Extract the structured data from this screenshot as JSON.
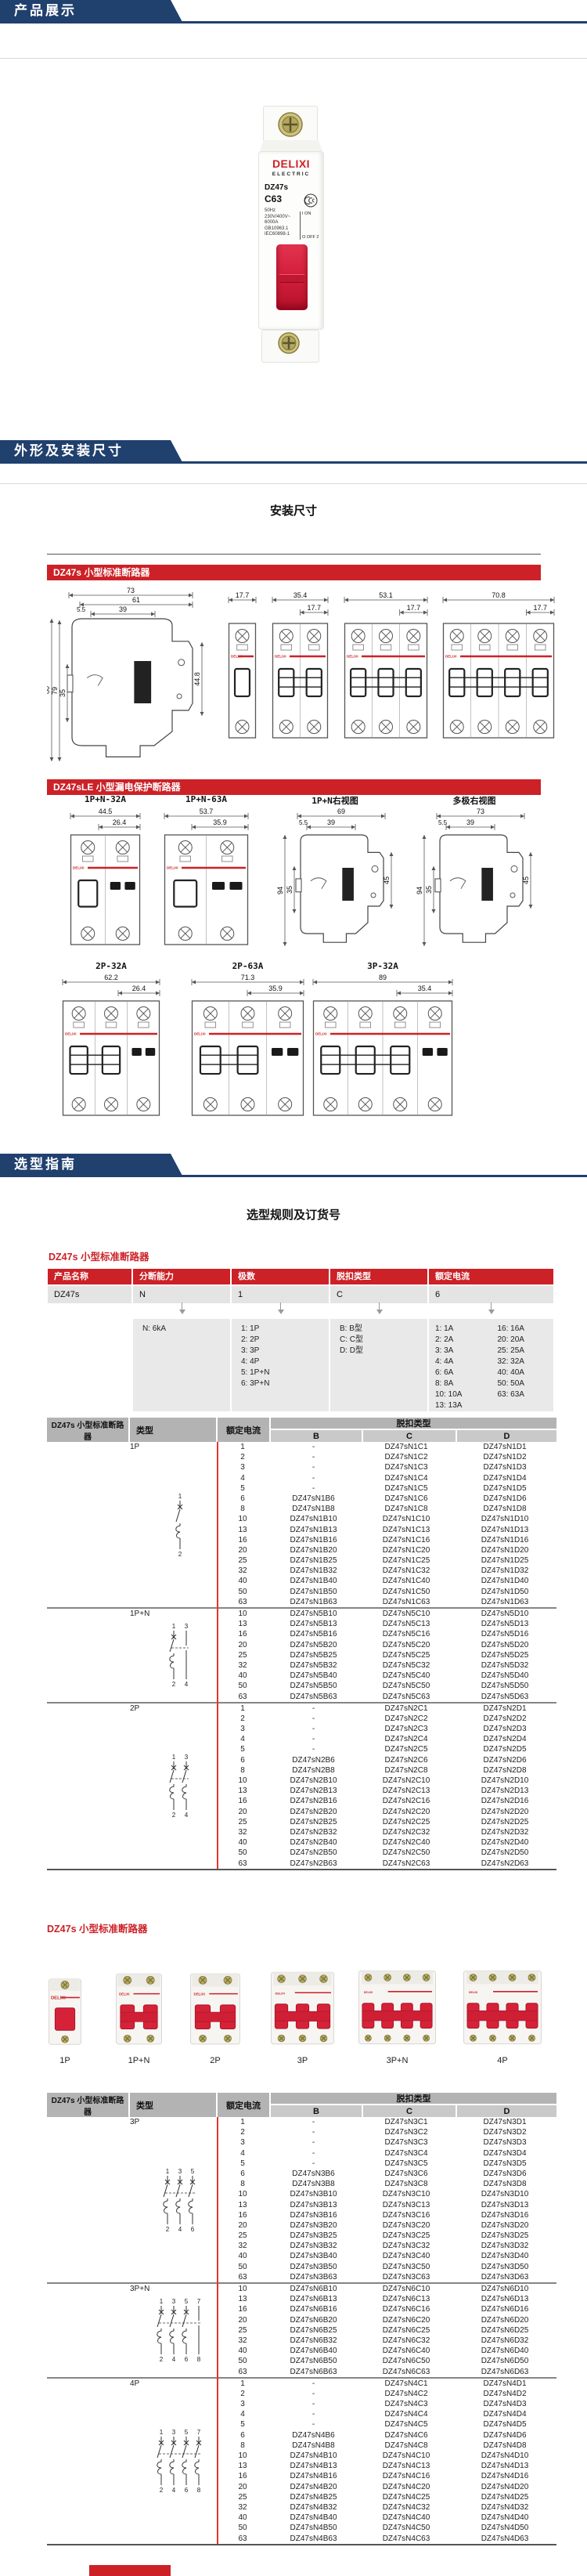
{
  "banners": {
    "products": "产品展示",
    "dimensions": "外形及安装尺寸",
    "selection": "选型指南"
  },
  "photo": {
    "brand": "DELIXI",
    "brand_sub": "ELECTRIC",
    "model": "DZ47s",
    "curve_rating": "C63",
    "specs": [
      "50Hz",
      "230V/400V~",
      "6000A",
      "GB10963.1",
      "IEC60898-1"
    ],
    "on_label": "I ON",
    "off_label": "O OFF 2",
    "ccc_mark": "CCC"
  },
  "install": {
    "title": "安装尺寸",
    "dz47s_banner": "DZ47s 小型标准断路器",
    "dz47sle_banner": "DZ47sLE 小型漏电保护断路器",
    "side_dims": {
      "total_w": "73",
      "body_w": "61",
      "mount_w": "39",
      "offset": "5.5",
      "total_h": "80",
      "front_h": "79",
      "rail_h": "35",
      "depth": "44.8"
    },
    "front_views": [
      {
        "total": "17.7"
      },
      {
        "total": "35.4",
        "module": "17.7"
      },
      {
        "total": "53.1",
        "module": "17.7"
      },
      {
        "total": "70.8",
        "module": "17.7"
      }
    ],
    "le_row1": [
      {
        "label": "1P+N-32A",
        "total": "44.5",
        "inner": "26.4"
      },
      {
        "label": "1P+N-63A",
        "total": "53.7",
        "inner": "35.9"
      },
      {
        "label": "1P+N右视图",
        "top": "69",
        "offset": "5.5",
        "mount": "39",
        "height": "94",
        "rail": "35",
        "depth": "45"
      },
      {
        "label": "多极右视图",
        "top": "73",
        "offset": "5.5",
        "mount": "39",
        "height": "94",
        "rail": "35",
        "depth": "45"
      }
    ],
    "le_row2": [
      {
        "label": "2P-32A",
        "total": "62.2",
        "inner": "26.4"
      },
      {
        "label": "2P-63A",
        "total": "71.3",
        "inner": "35.9"
      },
      {
        "label": "3P-32A",
        "total": "89",
        "inner": "35.4"
      }
    ]
  },
  "selection": {
    "title": "选型规则及订货号",
    "rule_table_title": "DZ47s 小型标准断路器",
    "rule_headers": [
      "产品名称",
      "分断能力",
      "极数",
      "脱扣类型",
      "额定电流"
    ],
    "rule_values": [
      "DZ47s",
      "N",
      "1",
      "C",
      "6"
    ],
    "breaking": [
      "N: 6kA"
    ],
    "poles": [
      "1: 1P",
      "2: 2P",
      "3: 3P",
      "4: 4P",
      "5: 1P+N",
      "6: 3P+N"
    ],
    "trip": [
      "B: B型",
      "C: C型",
      "D: D型"
    ],
    "current_a": [
      "1: 1A",
      "2: 2A",
      "3: 3A",
      "4: 4A",
      "6: 6A",
      "8: 8A",
      "10: 10A",
      "13: 13A"
    ],
    "current_b": [
      "16: 16A",
      "20: 20A",
      "25: 25A",
      "32: 32A",
      "40: 40A",
      "50: 50A",
      "63: 63A"
    ]
  },
  "gallery": {
    "title": "DZ47s 小型标准断路器",
    "items": [
      {
        "label": "1P",
        "modules": 1
      },
      {
        "label": "1P+N",
        "modules": 2
      },
      {
        "label": "2P",
        "modules": 2
      },
      {
        "label": "3P",
        "modules": 3
      },
      {
        "label": "3P+N",
        "modules": 4
      },
      {
        "label": "4P",
        "modules": 4
      }
    ]
  },
  "table1": {
    "col1": "DZ47s 小型标准断路器",
    "type_h": "类型",
    "current_h": "额定电流",
    "trip_h": "脱扣类型",
    "trip_cols": [
      "B",
      "C",
      "D"
    ],
    "sections": [
      {
        "type": "1P",
        "sym": {
          "poles": 1,
          "neutral": false,
          "top": "1",
          "bottom": "2"
        },
        "rows": [
          [
            "1",
            "-",
            "DZ47sN1C1",
            "DZ47sN1D1"
          ],
          [
            "2",
            "-",
            "DZ47sN1C2",
            "DZ47sN1D2"
          ],
          [
            "3",
            "-",
            "DZ47sN1C3",
            "DZ47sN1D3"
          ],
          [
            "4",
            "-",
            "DZ47sN1C4",
            "DZ47sN1D4"
          ],
          [
            "5",
            "-",
            "DZ47sN1C5",
            "DZ47sN1D5"
          ],
          [
            "6",
            "DZ47sN1B6",
            "DZ47sN1C6",
            "DZ47sN1D6"
          ],
          [
            "8",
            "DZ47sN1B8",
            "DZ47sN1C8",
            "DZ47sN1D8"
          ],
          [
            "10",
            "DZ47sN1B10",
            "DZ47sN1C10",
            "DZ47sN1D10"
          ],
          [
            "13",
            "DZ47sN1B13",
            "DZ47sN1C13",
            "DZ47sN1D13"
          ],
          [
            "16",
            "DZ47sN1B16",
            "DZ47sN1C16",
            "DZ47sN1D16"
          ],
          [
            "20",
            "DZ47sN1B20",
            "DZ47sN1C20",
            "DZ47sN1D20"
          ],
          [
            "25",
            "DZ47sN1B25",
            "DZ47sN1C25",
            "DZ47sN1D25"
          ],
          [
            "32",
            "DZ47sN1B32",
            "DZ47sN1C32",
            "DZ47sN1D32"
          ],
          [
            "40",
            "DZ47sN1B40",
            "DZ47sN1C40",
            "DZ47sN1D40"
          ],
          [
            "50",
            "DZ47sN1B50",
            "DZ47sN1C50",
            "DZ47sN1D50"
          ],
          [
            "63",
            "DZ47sN1B63",
            "DZ47sN1C63",
            "DZ47sN1D63"
          ]
        ]
      },
      {
        "type": "1P+N",
        "sym": {
          "poles": 2,
          "neutral": true,
          "top": "1 3",
          "bottom": "2 4"
        },
        "rows": [
          [
            "10",
            "DZ47sN5B10",
            "DZ47sN5C10",
            "DZ47sN5D10"
          ],
          [
            "13",
            "DZ47sN5B13",
            "DZ47sN5C13",
            "DZ47sN5D13"
          ],
          [
            "16",
            "DZ47sN5B16",
            "DZ47sN5C16",
            "DZ47sN5D16"
          ],
          [
            "20",
            "DZ47sN5B20",
            "DZ47sN5C20",
            "DZ47sN5D20"
          ],
          [
            "25",
            "DZ47sN5B25",
            "DZ47sN5C25",
            "DZ47sN5D25"
          ],
          [
            "32",
            "DZ47sN5B32",
            "DZ47sN5C32",
            "DZ47sN5D32"
          ],
          [
            "40",
            "DZ47sN5B40",
            "DZ47sN5C40",
            "DZ47sN5D40"
          ],
          [
            "50",
            "DZ47sN5B50",
            "DZ47sN5C50",
            "DZ47sN5D50"
          ],
          [
            "63",
            "DZ47sN5B63",
            "DZ47sN5C63",
            "DZ47sN5D63"
          ]
        ]
      },
      {
        "type": "2P",
        "sym": {
          "poles": 2,
          "neutral": false,
          "top": "1 3",
          "bottom": "2 4"
        },
        "rows": [
          [
            "1",
            "-",
            "DZ47sN2C1",
            "DZ47sN2D1"
          ],
          [
            "2",
            "-",
            "DZ47sN2C2",
            "DZ47sN2D2"
          ],
          [
            "3",
            "-",
            "DZ47sN2C3",
            "DZ47sN2D3"
          ],
          [
            "4",
            "-",
            "DZ47sN2C4",
            "DZ47sN2D4"
          ],
          [
            "5",
            "-",
            "DZ47sN2C5",
            "DZ47sN2D5"
          ],
          [
            "6",
            "DZ47sN2B6",
            "DZ47sN2C6",
            "DZ47sN2D6"
          ],
          [
            "8",
            "DZ47sN2B8",
            "DZ47sN2C8",
            "DZ47sN2D8"
          ],
          [
            "10",
            "DZ47sN2B10",
            "DZ47sN2C10",
            "DZ47sN2D10"
          ],
          [
            "13",
            "DZ47sN2B13",
            "DZ47sN2C13",
            "DZ47sN2D13"
          ],
          [
            "16",
            "DZ47sN2B16",
            "DZ47sN2C16",
            "DZ47sN2D16"
          ],
          [
            "20",
            "DZ47sN2B20",
            "DZ47sN2C20",
            "DZ47sN2D20"
          ],
          [
            "25",
            "DZ47sN2B25",
            "DZ47sN2C25",
            "DZ47sN2D25"
          ],
          [
            "32",
            "DZ47sN2B32",
            "DZ47sN2C32",
            "DZ47sN2D32"
          ],
          [
            "40",
            "DZ47sN2B40",
            "DZ47sN2C40",
            "DZ47sN2D40"
          ],
          [
            "50",
            "DZ47sN2B50",
            "DZ47sN2C50",
            "DZ47sN2D50"
          ],
          [
            "63",
            "DZ47sN2B63",
            "DZ47sN2C63",
            "DZ47sN2D63"
          ]
        ]
      }
    ]
  },
  "table2": {
    "col1": "DZ47s 小型标准断路器",
    "type_h": "类型",
    "current_h": "额定电流",
    "trip_h": "脱扣类型",
    "trip_cols": [
      "B",
      "C",
      "D"
    ],
    "sections": [
      {
        "type": "3P",
        "sym": {
          "poles": 3,
          "neutral": false,
          "top": "1 3 5",
          "bottom": "2 4 6"
        },
        "rows": [
          [
            "1",
            "-",
            "DZ47sN3C1",
            "DZ47sN3D1"
          ],
          [
            "2",
            "-",
            "DZ47sN3C2",
            "DZ47sN3D2"
          ],
          [
            "3",
            "-",
            "DZ47sN3C3",
            "DZ47sN3D3"
          ],
          [
            "4",
            "-",
            "DZ47sN3C4",
            "DZ47sN3D4"
          ],
          [
            "5",
            "-",
            "DZ47sN3C5",
            "DZ47sN3D5"
          ],
          [
            "6",
            "DZ47sN3B6",
            "DZ47sN3C6",
            "DZ47sN3D6"
          ],
          [
            "8",
            "DZ47sN3B8",
            "DZ47sN3C8",
            "DZ47sN3D8"
          ],
          [
            "10",
            "DZ47sN3B10",
            "DZ47sN3C10",
            "DZ47sN3D10"
          ],
          [
            "13",
            "DZ47sN3B13",
            "DZ47sN3C13",
            "DZ47sN3D13"
          ],
          [
            "16",
            "DZ47sN3B16",
            "DZ47sN3C16",
            "DZ47sN3D16"
          ],
          [
            "20",
            "DZ47sN3B20",
            "DZ47sN3C20",
            "DZ47sN3D20"
          ],
          [
            "25",
            "DZ47sN3B25",
            "DZ47sN3C25",
            "DZ47sN3D25"
          ],
          [
            "32",
            "DZ47sN3B32",
            "DZ47sN3C32",
            "DZ47sN3D32"
          ],
          [
            "40",
            "DZ47sN3B40",
            "DZ47sN3C40",
            "DZ47sN3D40"
          ],
          [
            "50",
            "DZ47sN3B50",
            "DZ47sN3C50",
            "DZ47sN3D50"
          ],
          [
            "63",
            "DZ47sN3B63",
            "DZ47sN3C63",
            "DZ47sN3D63"
          ]
        ]
      },
      {
        "type": "3P+N",
        "sym": {
          "poles": 4,
          "neutral": true,
          "top": "1 3 5 7",
          "bottom": "2 4 6 8"
        },
        "rows": [
          [
            "10",
            "DZ47sN6B10",
            "DZ47sN6C10",
            "DZ47sN6D10"
          ],
          [
            "13",
            "DZ47sN6B13",
            "DZ47sN6C13",
            "DZ47sN6D13"
          ],
          [
            "16",
            "DZ47sN6B16",
            "DZ47sN6C16",
            "DZ47sN6D16"
          ],
          [
            "20",
            "DZ47sN6B20",
            "DZ47sN6C20",
            "DZ47sN6D20"
          ],
          [
            "25",
            "DZ47sN6B25",
            "DZ47sN6C25",
            "DZ47sN6D25"
          ],
          [
            "32",
            "DZ47sN6B32",
            "DZ47sN6C32",
            "DZ47sN6D32"
          ],
          [
            "40",
            "DZ47sN6B40",
            "DZ47sN6C40",
            "DZ47sN6D40"
          ],
          [
            "50",
            "DZ47sN6B50",
            "DZ47sN6C50",
            "DZ47sN6D50"
          ],
          [
            "63",
            "DZ47sN6B63",
            "DZ47sN6C63",
            "DZ47sN6D63"
          ]
        ]
      },
      {
        "type": "4P",
        "sym": {
          "poles": 4,
          "neutral": false,
          "top": "1 3 5 7",
          "bottom": "2 4 6 8"
        },
        "rows": [
          [
            "1",
            "-",
            "DZ47sN4C1",
            "DZ47sN4D1"
          ],
          [
            "2",
            "-",
            "DZ47sN4C2",
            "DZ47sN4D2"
          ],
          [
            "3",
            "-",
            "DZ47sN4C3",
            "DZ47sN4D3"
          ],
          [
            "4",
            "-",
            "DZ47sN4C4",
            "DZ47sN4D4"
          ],
          [
            "5",
            "-",
            "DZ47sN4C5",
            "DZ47sN4D5"
          ],
          [
            "6",
            "DZ47sN4B6",
            "DZ47sN4C6",
            "DZ47sN4D6"
          ],
          [
            "8",
            "DZ47sN4B8",
            "DZ47sN4C8",
            "DZ47sN4D8"
          ],
          [
            "10",
            "DZ47sN4B10",
            "DZ47sN4C10",
            "DZ47sN4D10"
          ],
          [
            "13",
            "DZ47sN4B13",
            "DZ47sN4C13",
            "DZ47sN4D13"
          ],
          [
            "16",
            "DZ47sN4B16",
            "DZ47sN4C16",
            "DZ47sN4D16"
          ],
          [
            "20",
            "DZ47sN4B20",
            "DZ47sN4C20",
            "DZ47sN4D20"
          ],
          [
            "25",
            "DZ47sN4B25",
            "DZ47sN4C25",
            "DZ47sN4D25"
          ],
          [
            "32",
            "DZ47sN4B32",
            "DZ47sN4C32",
            "DZ47sN4D32"
          ],
          [
            "40",
            "DZ47sN4B40",
            "DZ47sN4C40",
            "DZ47sN4D40"
          ],
          [
            "50",
            "DZ47sN4B50",
            "DZ47sN4C50",
            "DZ47sN4D50"
          ],
          [
            "63",
            "DZ47sN4B63",
            "DZ47sN4C63",
            "DZ47sN4D63"
          ]
        ]
      }
    ]
  }
}
